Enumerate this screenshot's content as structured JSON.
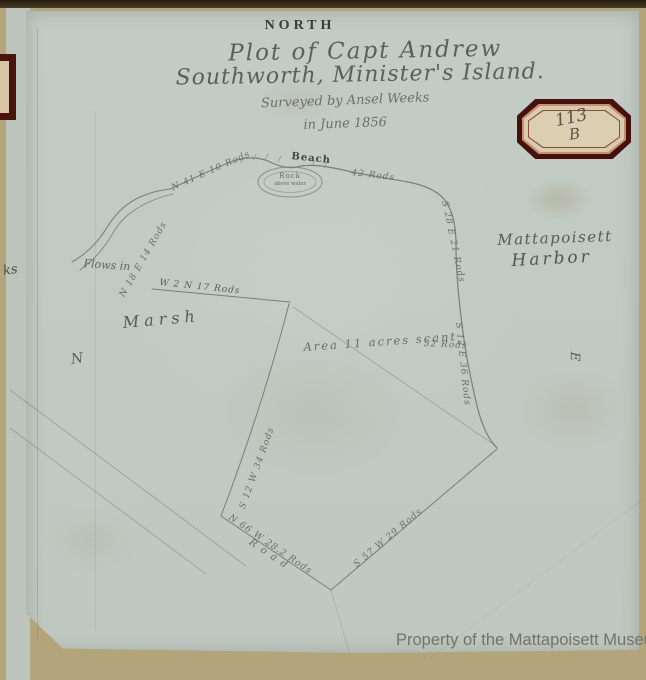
{
  "map": {
    "north_label": "NORTH",
    "title_line1": "Plot of Capt Andrew",
    "title_line2": "Southworth, Minister's Island.",
    "surveyed_line": "Surveyed by Ansel Weeks",
    "date_line": "in June 1856",
    "badge": {
      "number": "113",
      "letter": "B"
    },
    "labels": {
      "harbor_line1": "Mattapoisett",
      "harbor_line2": "Harbor",
      "marsh": "Marsh",
      "area": "Area 11 acres scant",
      "beach": "Beach",
      "beach_length": "42 Rods",
      "rock_stamp_line1": "Rock",
      "rock_stamp_line2": "above water",
      "flows": "Flows in",
      "road": "Road",
      "compass_n": "N",
      "compass_e": "E",
      "fragment": "ks"
    },
    "bearings": {
      "creek_lower": "N 18 E 14 Rods",
      "creek_upper": "N 41 E 10 Rods",
      "marsh_line": "W 2 N 17 Rods",
      "shore_upper": "S 28 E 21 Rods",
      "shore_lower": "S 12 E 36 Rods",
      "shore_mid": "52 Rods",
      "west_line": "S 12 W 34 Rods",
      "road_line": "N 66 W 28.2 Rods",
      "south_line": "S 57 W 29 Rods"
    },
    "watermark": "Property of the Mattapoisett Museum",
    "colors": {
      "album_tan": "#b4a47c",
      "sheet_blue_gray": "#c6d0ca",
      "printed_ink": "#3c3a33",
      "handwriting_ink": "#59615a",
      "survey_line": "#676d64",
      "badge_maroon": "#45110c",
      "badge_cream": "#d9ccae",
      "watermark_gray": "#72726b"
    }
  }
}
